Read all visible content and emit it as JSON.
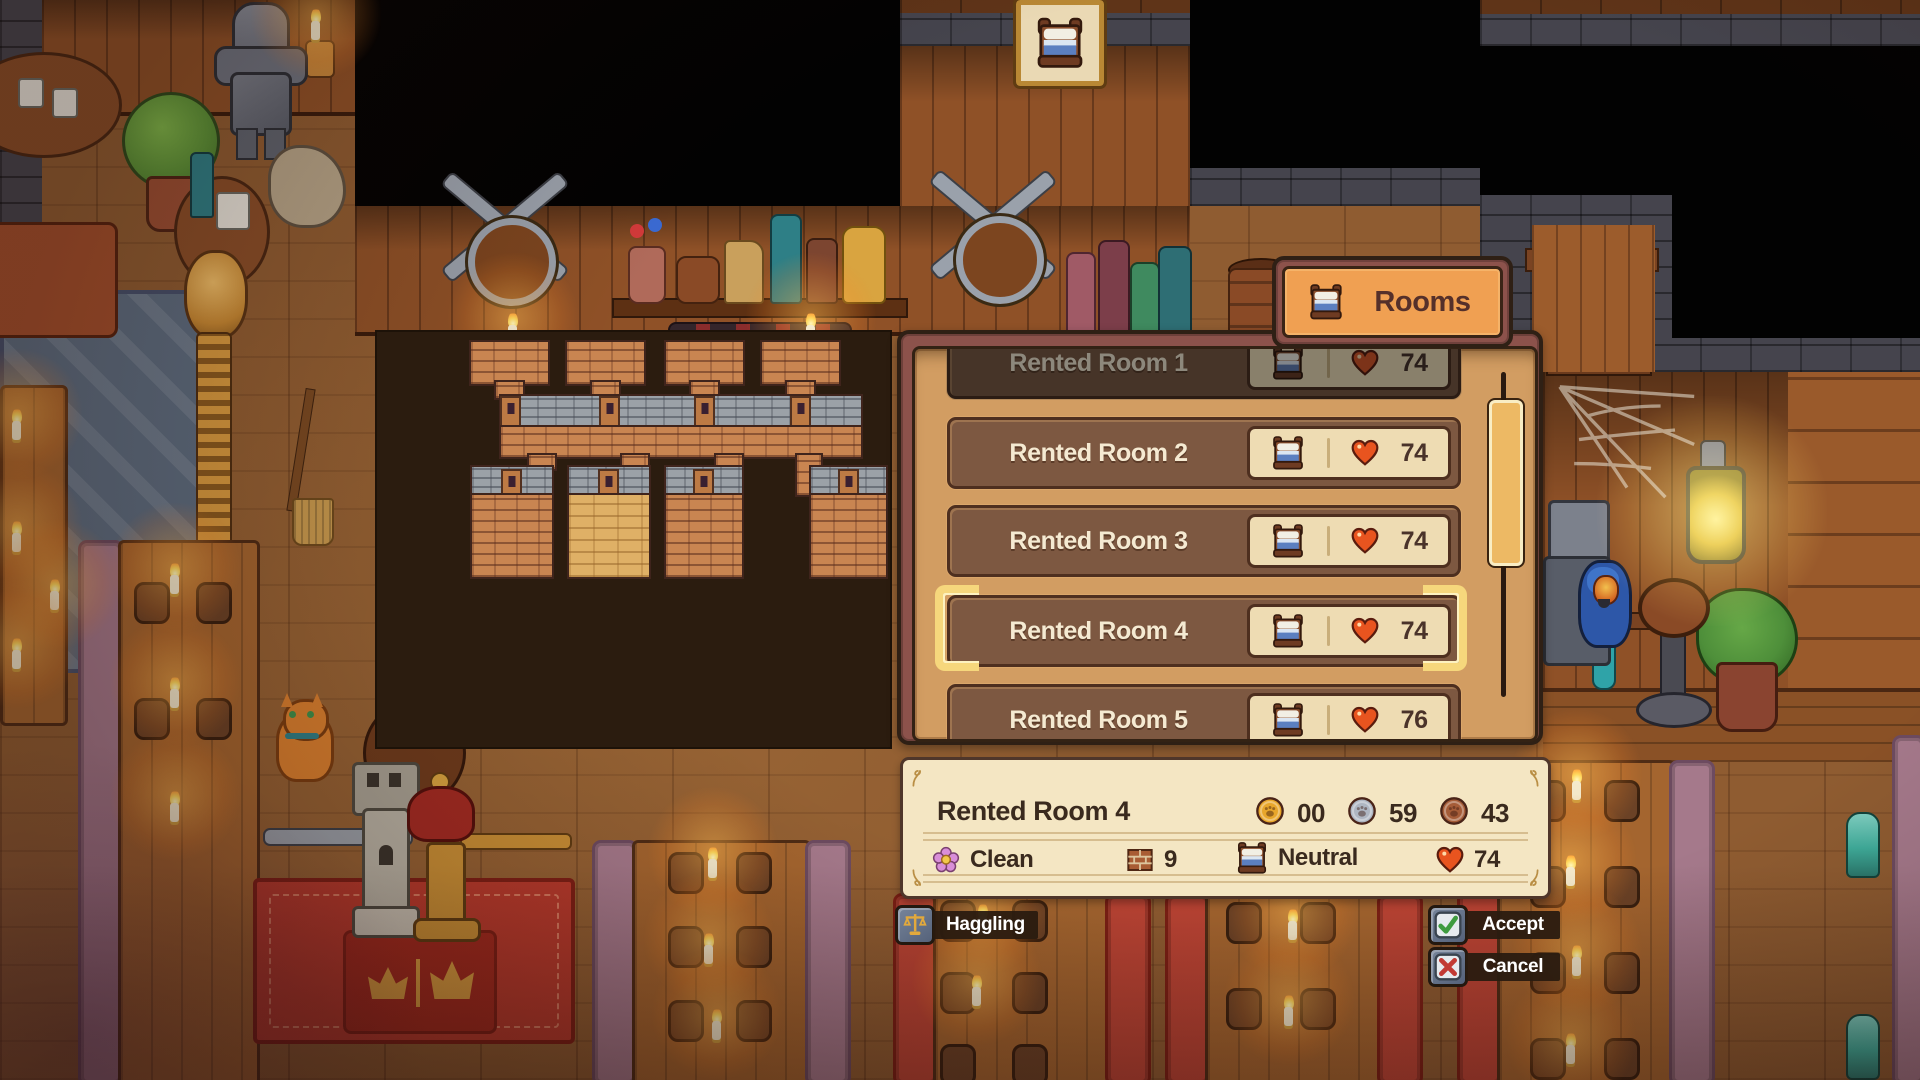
{
  "tab": {
    "label": "Rooms"
  },
  "rooms_panel": {
    "rows": [
      {
        "name": "Rented Room 1",
        "hearts": "74"
      },
      {
        "name": "Rented Room 2",
        "hearts": "74"
      },
      {
        "name": "Rented Room 3",
        "hearts": "74"
      },
      {
        "name": "Rented Room 4",
        "hearts": "74"
      },
      {
        "name": "Rented Room 5",
        "hearts": "76"
      }
    ],
    "selected_row": "Rented Room 4"
  },
  "detail_panel": {
    "title": "Rented Room 4",
    "price": {
      "gold": "00",
      "silver": "59",
      "copper": "43"
    },
    "stats": {
      "cleanliness": "Clean",
      "beds": "9",
      "mood": "Neutral",
      "hearts": "74"
    }
  },
  "actions": {
    "haggling": "Haggling",
    "accept": "Accept",
    "cancel": "Cancel"
  },
  "icons": {
    "tab": "bed-icon",
    "room_value": "heart-icon",
    "price": [
      "gold-coin-icon",
      "silver-coin-icon",
      "copper-coin-icon"
    ],
    "stats": [
      "flower-icon",
      "brick-icon",
      "bed-icon",
      "heart-icon"
    ],
    "haggling": "scales-icon",
    "accept": "check-icon",
    "cancel": "x-icon",
    "wall_sign": "bed-sign-icon"
  },
  "colors": {
    "panel_tan": "#d29d62",
    "frame_maroon": "#8c524b",
    "row_brown": "#7d5841",
    "cream_text": "#f5ead2",
    "pill_bg": "#eedcb3",
    "selection_gold": "#f6d77c",
    "heart_red": "#e8541f",
    "tab_orange": "#f0a052",
    "detail_bg": "#f4e6c3",
    "button_strip": "#2a1b10"
  }
}
